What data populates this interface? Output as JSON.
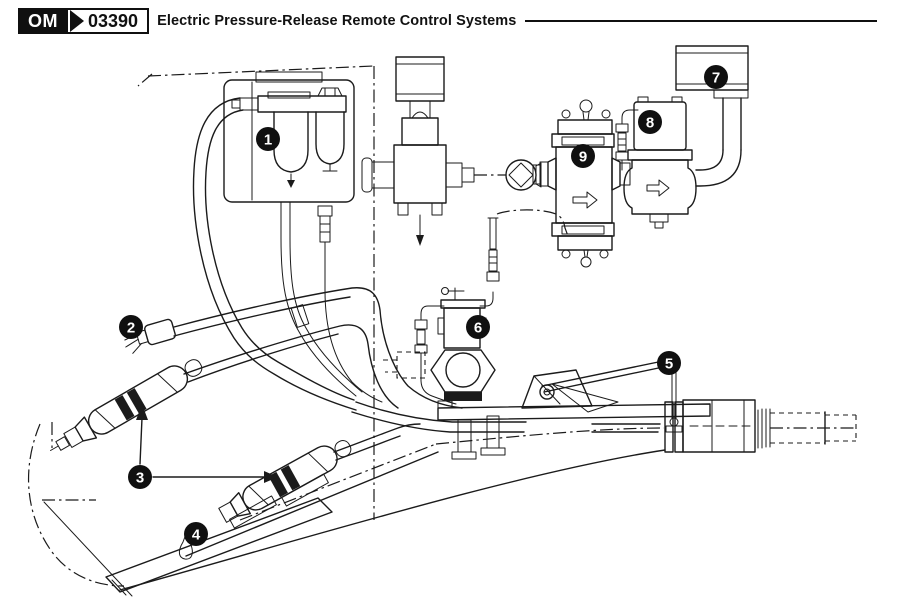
{
  "header": {
    "manual_code": "OM",
    "section_number": "03390",
    "title": "Electric Pressure-Release Remote Control Systems"
  },
  "colors": {
    "ink": "#1b1b1b",
    "callout_background": "#101010",
    "page_background": "#ffffff"
  },
  "diagram": {
    "callouts": [
      {
        "number": "1"
      },
      {
        "number": "2"
      },
      {
        "number": "3"
      },
      {
        "number": "4"
      },
      {
        "number": "5"
      },
      {
        "number": "6"
      },
      {
        "number": "7"
      },
      {
        "number": "8"
      },
      {
        "number": "9"
      }
    ]
  }
}
